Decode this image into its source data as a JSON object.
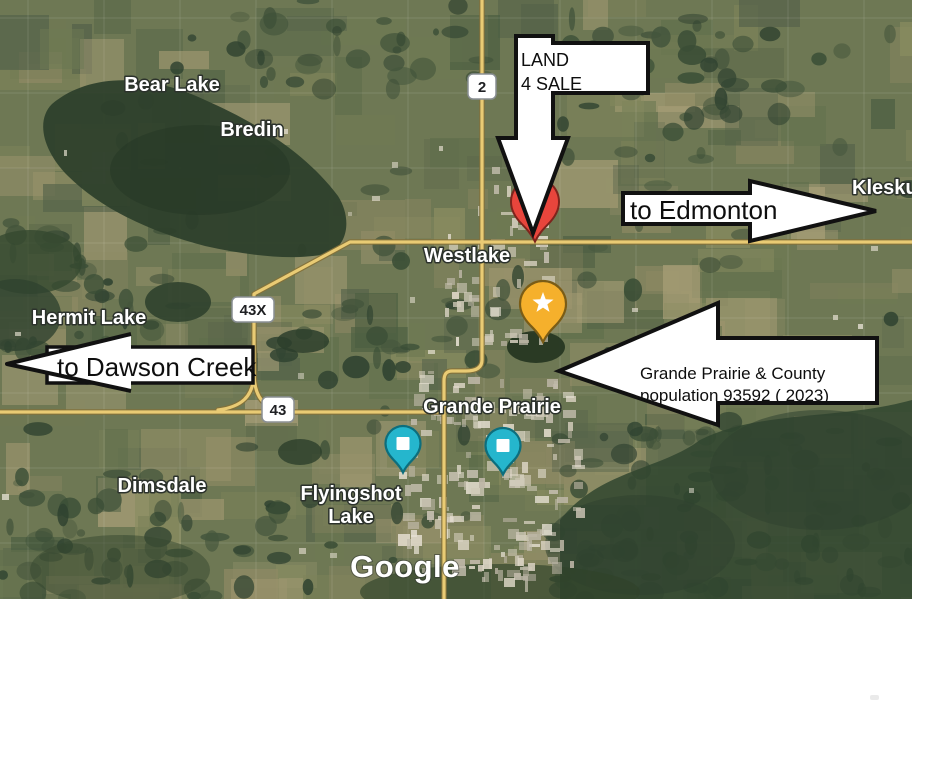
{
  "map": {
    "attribution_logo": "Google",
    "place_labels": [
      {
        "name": "bear-lake",
        "text": "Bear Lake"
      },
      {
        "name": "bredin",
        "text": "Bredin"
      },
      {
        "name": "kleskun",
        "text": "Kleskun"
      },
      {
        "name": "westlake",
        "text": "Westlake"
      },
      {
        "name": "hermit-lake",
        "text": "Hermit Lake"
      },
      {
        "name": "grande-prairie",
        "text": "Grande Prairie"
      },
      {
        "name": "dimsdale",
        "text": "Dimsdale"
      },
      {
        "name": "flyingshot-line1",
        "text": "Flyingshot"
      },
      {
        "name": "flyingshot-line2",
        "text": "Lake"
      }
    ],
    "road_shields": [
      {
        "route": "2"
      },
      {
        "route": "43X"
      },
      {
        "route": "43"
      }
    ],
    "markers": {
      "red_pin": {
        "icon": "map-pin",
        "color": "#E8453C"
      },
      "star_pin": {
        "icon": "star",
        "color": "#F5B02C"
      },
      "teal_pins": {
        "icon": "square",
        "color": "#25B6CD",
        "count": 2
      }
    }
  },
  "annotations": {
    "land_sale": {
      "line1": "LAND",
      "line2": "4 SALE"
    },
    "to_edmonton": "to Edmonton",
    "to_dawson_creek": "to Dawson Creek",
    "info_arrow": {
      "line1": "Grande Prairie & County",
      "line2": "population 93592 ( 2023)"
    }
  },
  "colors": {
    "road": "#E9CB74",
    "road_casing": "#83713A",
    "field": "#77815A",
    "forest": "#35492F",
    "water": "#2E402C",
    "urban": "#D6D0C0",
    "annotation_fill": "#FFFFFF",
    "annotation_stroke": "#111111"
  }
}
